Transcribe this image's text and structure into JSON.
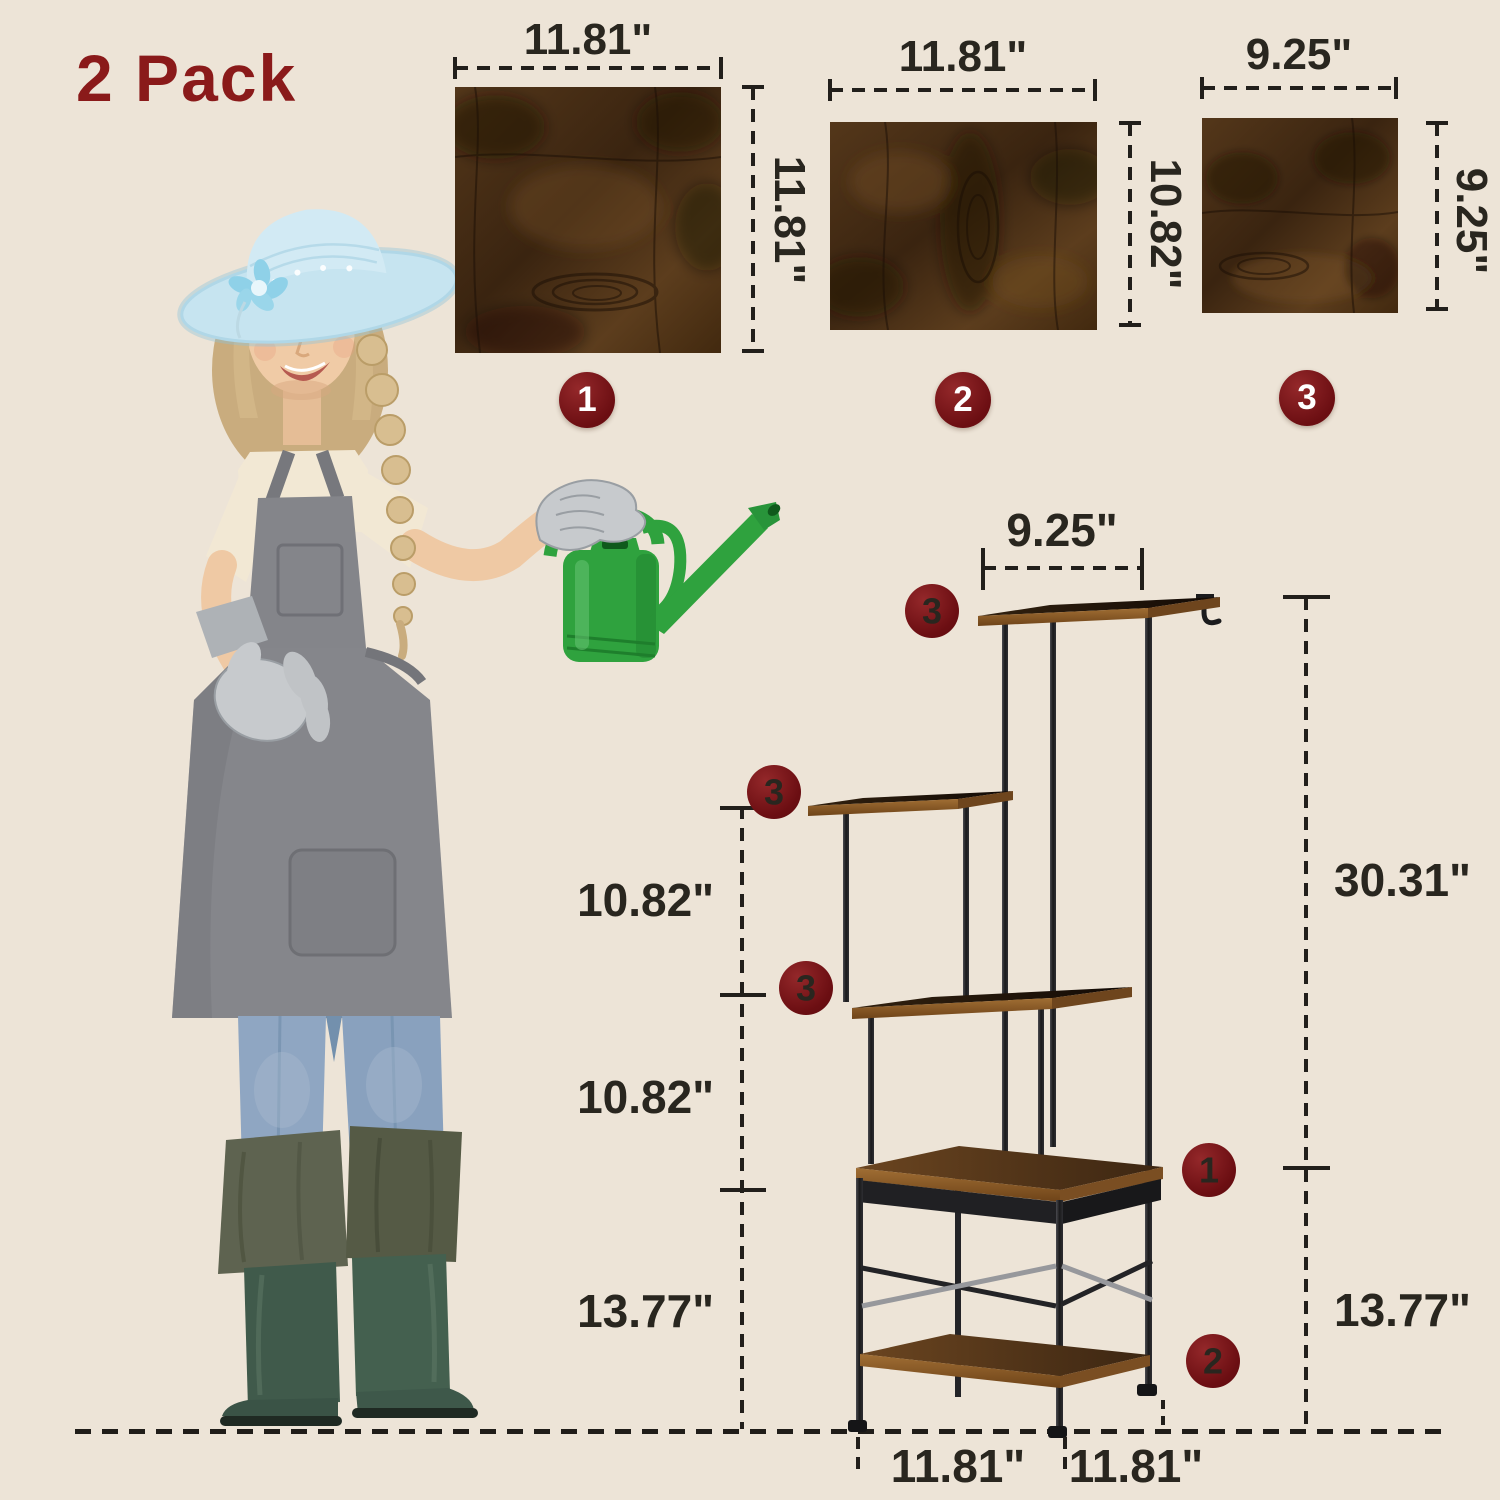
{
  "title": "2 Pack",
  "colors": {
    "background": "#EDE4D7",
    "accent_red": "#8A1A1A",
    "badge_red": "#7A1418",
    "dimension_ink": "#221F1B",
    "wood": "#4E3217",
    "metal": "#232326",
    "can_green": "#2FA23E"
  },
  "panels": [
    {
      "badge": "1",
      "width_label": "11.81\"",
      "height_label": "11.81\""
    },
    {
      "badge": "2",
      "width_label": "11.81\"",
      "height_label": "10.82\""
    },
    {
      "badge": "3",
      "width_label": "9.25\"",
      "height_label": "9.25\""
    }
  ],
  "stand": {
    "top_width_label": "9.25\"",
    "left_dim_labels": [
      "10.82\"",
      "10.82\"",
      "13.77\""
    ],
    "right_dim_labels": [
      "30.31\"",
      "13.77\""
    ],
    "bottom_dim_labels": [
      "11.81\"",
      "11.81\""
    ],
    "shelf_badges": {
      "upper": "3",
      "middle": "3",
      "lower": "3",
      "table": "1",
      "base": "2"
    }
  }
}
